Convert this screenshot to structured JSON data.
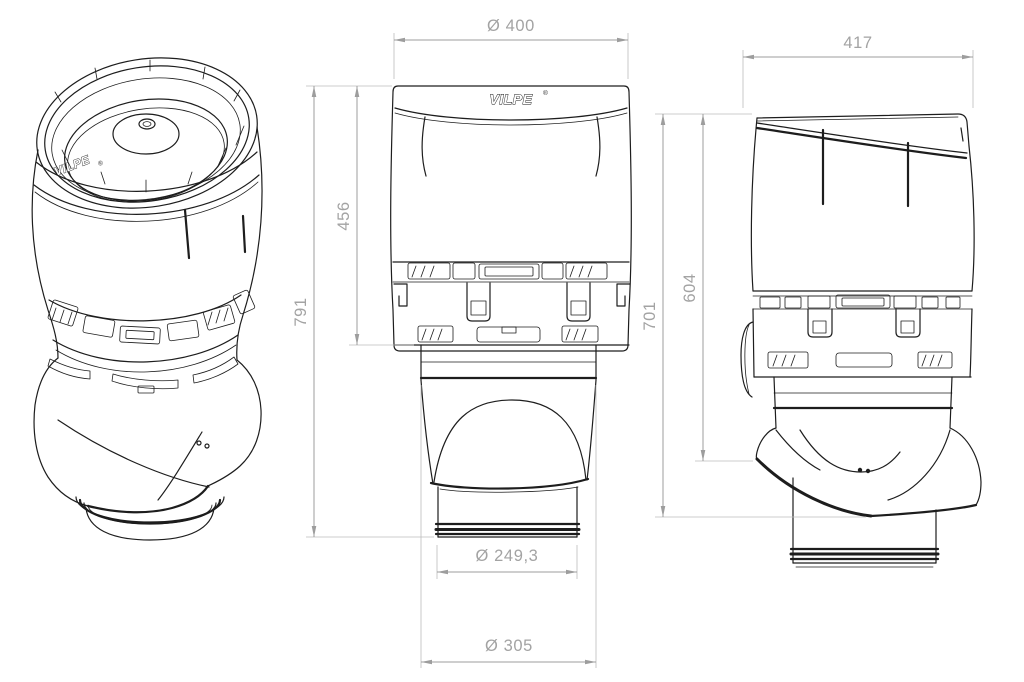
{
  "title": "VILPE ventilation fan technical drawing",
  "colors": {
    "background": "#ffffff",
    "drawing_line": "#1d1d1d",
    "dimension_line": "#9d9d9d",
    "dimension_text": "#a3a3a3"
  },
  "brand": {
    "name": "VILPE",
    "registered": "®"
  },
  "views": {
    "iso": {
      "label": "perspective view"
    },
    "front": {
      "label": "front view"
    },
    "side": {
      "label": "side view"
    }
  },
  "dimensions": {
    "front": {
      "top_diameter": "Ø 400",
      "upper_section_height": "456",
      "total_height": "791",
      "pipe_diameter": "Ø 249,3",
      "collar_diameter": "Ø 305"
    },
    "side": {
      "overall_depth": "417",
      "height_to_skirt_bottom": "701",
      "height_to_skirt_edge": "604"
    }
  }
}
